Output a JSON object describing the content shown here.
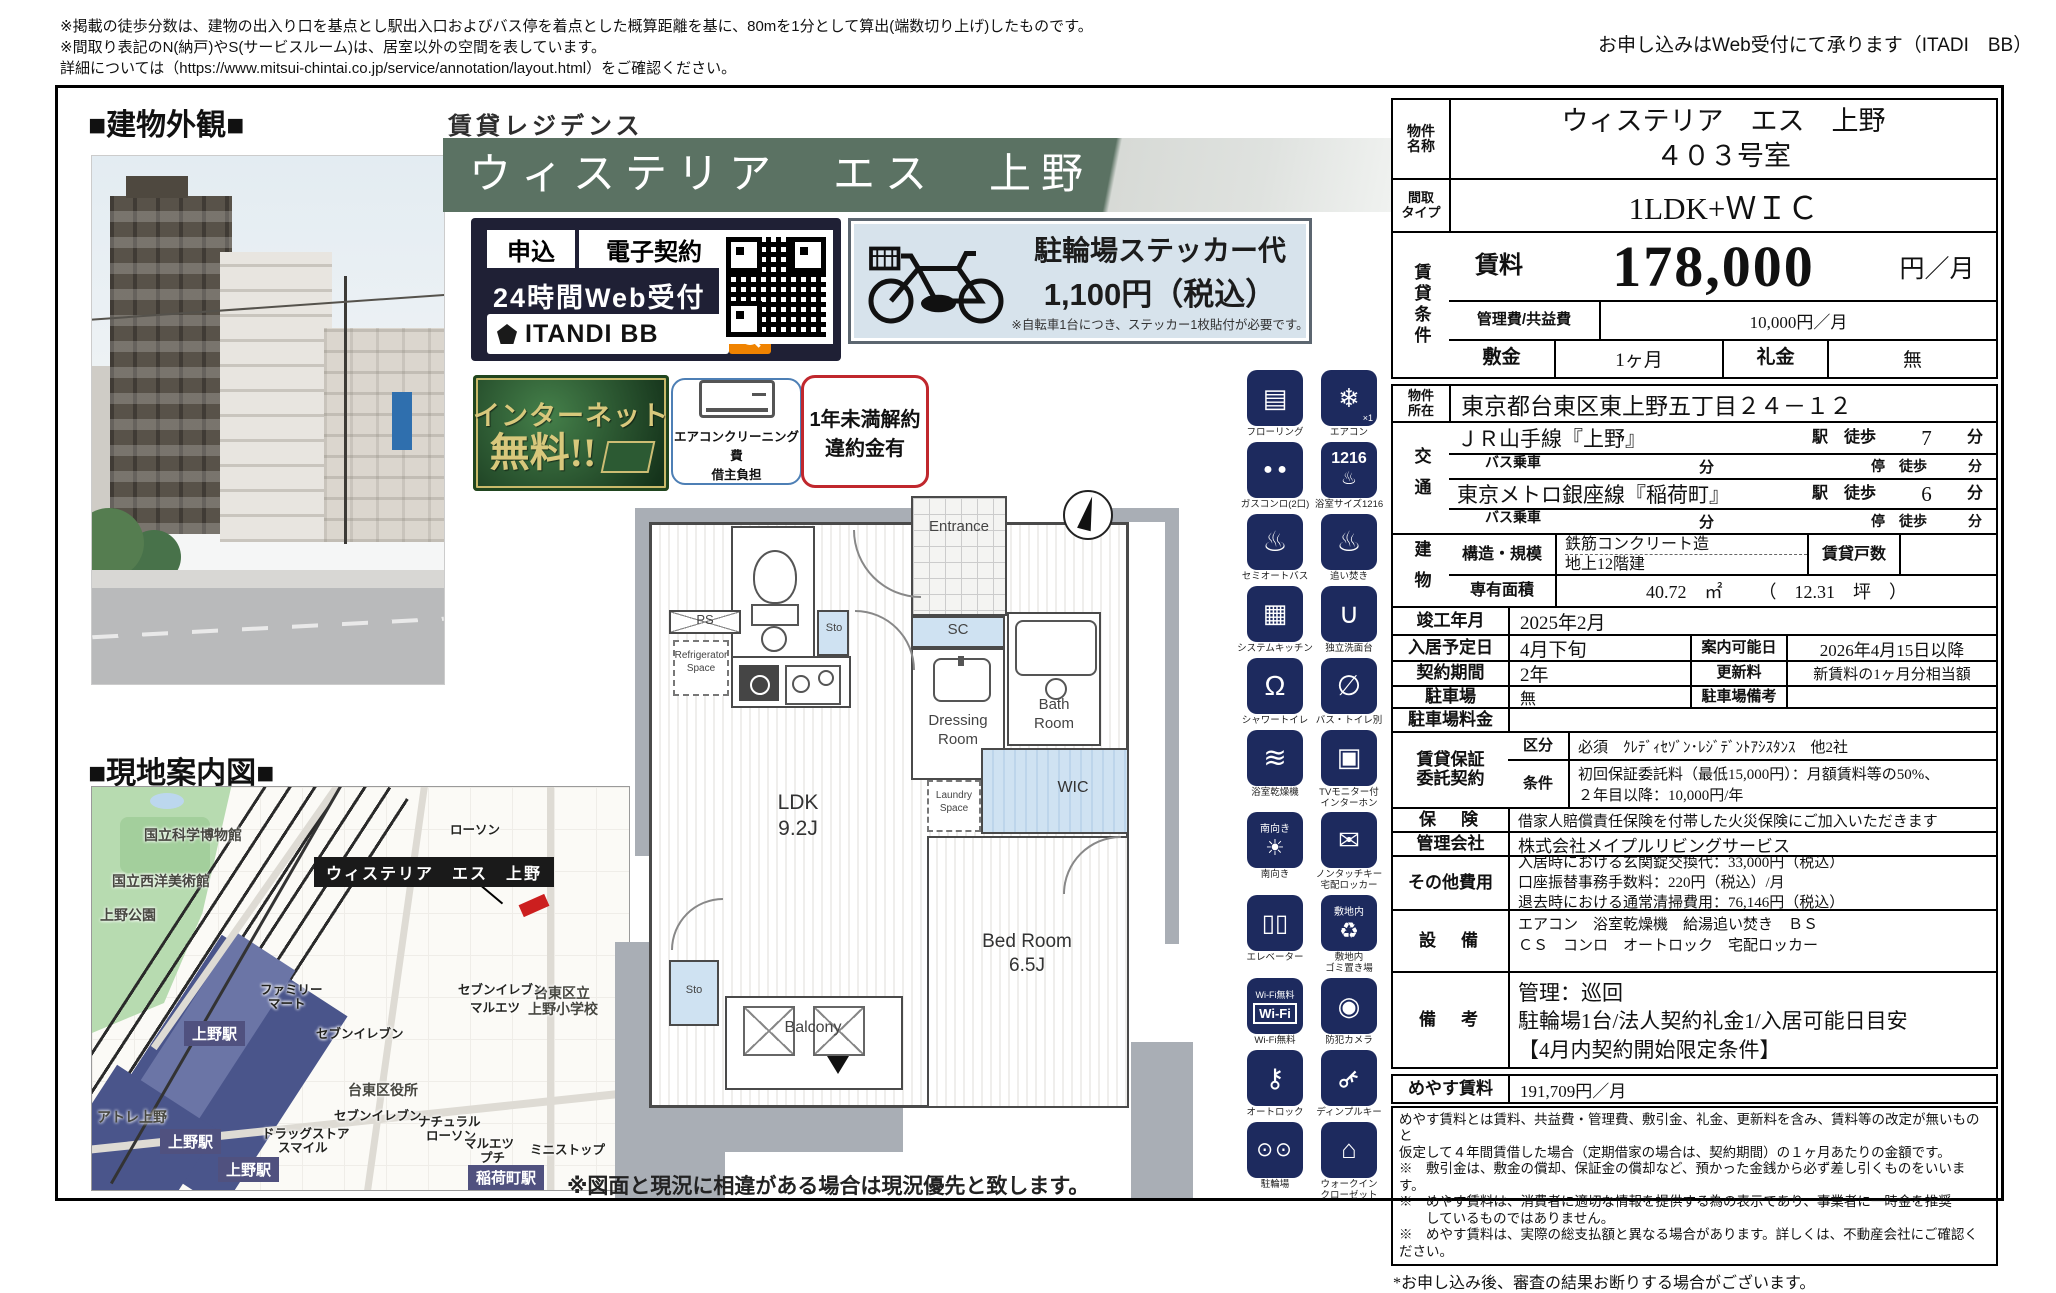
{
  "header": {
    "disclaimer_1": "※掲載の徒歩分数は、建物の出入り口を基点とし駅出入口およびバス停を着点とした概算距離を基に、80mを1分として算出(端数切り上げ)したものです。",
    "disclaimer_2": "※間取り表記のN(納戸)やS(サービスルーム)は、居室以外の空間を表しています。",
    "disclaimer_3": "詳細については（https://www.mitsui-chintai.co.jp/service/annotation/layout.html）をご確認ください。",
    "web_note": "お申し込みはWeb受付にて承ります（ITADI　BB）"
  },
  "left": {
    "exterior_title": "■建物外観■",
    "map_title": "■現地案内図■"
  },
  "banner": {
    "kicker": "賃貸レジデンス",
    "name": "ウィステリア　エス　上野"
  },
  "itandi": {
    "apply": "申込",
    "econtract": "電子契約",
    "web": "24時間Web受付",
    "brand": "ITANDI BB"
  },
  "bike": {
    "line1": "駐輪場ステッカー代",
    "line2": "1,100円（税込）",
    "line3": "※自転車1台につき、ステッカー1枚貼付が必要です。"
  },
  "badges": {
    "internet_1": "インターネット",
    "internet_2": "無料!!",
    "aircon_1": "エアコンクリーニング費",
    "aircon_2": "借主負担",
    "cancel_1": "1年未満解約",
    "cancel_2": "違約金有"
  },
  "fp": {
    "entrance": "Entrance",
    "sc": "SC",
    "sto_upper": "Sto",
    "ps_left": "PS",
    "fridge_1": "Refrigerator",
    "fridge_2": "Space",
    "dressing_1": "Dressing",
    "dressing_2": "Room",
    "bath_1": "Bath",
    "bath_2": "Room",
    "ps_small": "PS",
    "laundry_1": "Laundry",
    "laundry_2": "Space",
    "wic": "WIC",
    "ldk_1": "LDK",
    "ldk_2": "9.2J",
    "bed_1": "Bed Room",
    "bed_2": "6.5J",
    "sto_lower": "Sto",
    "balcony": "Balcony",
    "note": "※図面と現況に相違がある場合は現況優先と致します。"
  },
  "map": {
    "property": "ウィステリア　エス　上野",
    "areas": [
      "国立科学博物館",
      "国立西洋美術館",
      "上野公園",
      "台東区役所",
      "台東区立",
      "上野小学校",
      "アトレ上野"
    ],
    "stations": [
      "上野駅",
      "上野駅",
      "上野駅",
      "稲荷町駅"
    ],
    "pois": [
      "ローソン",
      "ファミリー",
      "マート",
      "セブンイレブン",
      "セブンイレブン",
      "マルエツ",
      "ドラッグストア",
      "スマイル",
      "セブンイレブン",
      "ナチュラル",
      "ローソン",
      "マルエツ",
      "プチ",
      "ミニストップ"
    ]
  },
  "icons": [
    {
      "label": "フローリング",
      "glyph": "▤"
    },
    {
      "label": "エアコン",
      "glyph": "❄",
      "sub": "×1"
    },
    {
      "label": "ガスコンロ(2口)",
      "glyph": "● ●"
    },
    {
      "label": "浴室サイズ1216",
      "glyph": "1216"
    },
    {
      "label": "セミオートバス",
      "glyph": "♨"
    },
    {
      "label": "追い焚き",
      "glyph": "♨"
    },
    {
      "label": "システムキッチン",
      "glyph": "▦"
    },
    {
      "label": "独立洗面台",
      "glyph": "∪"
    },
    {
      "label": "シャワートイレ",
      "glyph": "Ω"
    },
    {
      "label": "バス・トイレ別",
      "glyph": "∅"
    },
    {
      "label": "浴室乾燥機",
      "glyph": "≋"
    },
    {
      "label": "TVモニター付",
      "label2": "インターホン",
      "glyph": "▣"
    },
    {
      "label": "南向き",
      "glyph": "☀",
      "top": "南向き"
    },
    {
      "label": "ノンタッチキー",
      "label2": "宅配ロッカー",
      "glyph": "✉"
    },
    {
      "label": "エレベーター",
      "glyph": "▯▯"
    },
    {
      "label": "敷地内",
      "label2": "ゴミ置き場",
      "glyph": "♻",
      "top": "敷地内"
    },
    {
      "label": "Wi-Fi無料",
      "glyph": "Wi-Fi",
      "top": "Wi-Fi無料"
    },
    {
      "label": "防犯カメラ",
      "glyph": "◉"
    },
    {
      "label": "オートロック",
      "glyph": "⚷"
    },
    {
      "label": "ディンプルキー",
      "glyph": "⚷"
    },
    {
      "label": "駐輪場",
      "glyph": "⊙⊙"
    },
    {
      "label": "ウォークイン",
      "label2": "クローゼット",
      "glyph": "⌂"
    }
  ],
  "table": {
    "name_label_1": "物件",
    "name_label_2": "名称",
    "name_value_1": "ウィステリア　エス　上野",
    "name_value_2": "４０３号室",
    "type_label_1": "間取",
    "type_label_2": "タイプ",
    "type_value": "1LDK+ＷＩＣ",
    "cond_label": "賃貸条件",
    "rent_label": "賃料",
    "rent_value": "178,000",
    "rent_unit": "円／月",
    "mgmt_label": "管理費/共益費",
    "mgmt_value": "10,000円／月",
    "deposit_label": "敷金",
    "deposit_value": "1ヶ月",
    "key_label": "礼金",
    "key_value": "無",
    "addr_label_1": "物件",
    "addr_label_2": "所在",
    "addr_value": "東京都台東区東上野五丁目２４－１２",
    "transport_label": "交通",
    "t1_line": "ＪＲ山手線『上野』",
    "t1_mid": "駅　徒歩",
    "t1_min": "7",
    "t1_unit": "分",
    "t2_line": "バス乗車",
    "t2_blank_unit": "分",
    "t2_mid": "停　徒歩",
    "t2_unit": "分",
    "t3_line": "東京メトロ銀座線『稲荷町』",
    "t3_mid": "駅　徒歩",
    "t3_min": "6",
    "t3_unit": "分",
    "t4_line": "バス乗車",
    "t4_blank_unit": "分",
    "t4_mid": "停　徒歩",
    "t4_unit": "分",
    "bld_label": "建物",
    "structure_label": "構造・規模",
    "structure_value_1": "鉄筋コンクリート造",
    "structure_value_2": "地上12階建",
    "units_label": "賃貸戸数",
    "units_value": "",
    "area_label": "専有面積",
    "area_value": "40.72　㎡",
    "area_tsubo": "（　12.31　坪　）",
    "completion_label": "竣工年月",
    "completion_value": "2025年2月",
    "movein_label": "入居予定日",
    "movein_value": "4月下旬",
    "guide_label": "案内可能日",
    "guide_value": "2026年4月15日以降",
    "contract_label": "契約期間",
    "contract_value": "2年",
    "renewal_label": "更新料",
    "renewal_value": "新賃料の1ヶ月分相当額",
    "parking_label": "駐車場",
    "parking_value": "無",
    "parking_note_label": "駐車場備考",
    "parking_note_value": "",
    "parking_fee_label": "駐車場料金",
    "parking_fee_value": "",
    "guarantee_label_1": "賃貸保証",
    "guarantee_label_2": "委託契約",
    "g_class_label": "区分",
    "g_class_value": "必須　ｸﾚﾃﾞｨｾｿﾞﾝ･ﾚｼﾞﾃﾞﾝﾄｱｼｽﾀﾝｽ　他2社",
    "g_cond_label": "条件",
    "g_cond_value_1": "初回保証委託料（最低15,000円）：月額賃料等の50%、",
    "g_cond_value_2": "２年目以降：10,000円/年",
    "insurance_label": "保　険",
    "insurance_value": "借家人賠償責任保険を付帯した火災保険にご加入いただきます",
    "mgmtco_label": "管理会社",
    "mgmtco_value": "株式会社メイプルリビングサービス",
    "other_label": "その他費用",
    "other_value_1": "入居時における玄関錠交換代：33,000円（税込）",
    "other_value_2": "口座振替事務手数料：220円（税込）/月",
    "other_value_3": "退去時における通常清掃費用：76,146円（税込）",
    "equip_label": "設　備",
    "equip_value_1": "エアコン　浴室乾燥機　給湯追い焚き　ＢＳ",
    "equip_value_2": "ＣＳ　コンロ　オートロック　宅配ロッカー",
    "remarks_label": "備　考",
    "remarks_value_1": "管理：巡回",
    "remarks_value_2": "駐輪場1台/法人契約礼金1/入居可能日目安",
    "remarks_value_3": "【4月内契約開始限定条件】",
    "meyasu_label": "めやす賃料",
    "meyasu_value": "191,709円／月",
    "note_1": "めやす賃料とは賃料、共益費・管理費、敷引金、礼金、更新料を含み、賃料等の改定が無いものと",
    "note_2": "仮定して４年間賃借した場合（定期借家の場合は、契約期間）の１ヶ月あたりの金額です。",
    "note_3": "※　敷引金は、敷金の償却、保証金の償却など、預かった金銭から必ず差し引くものをいいます。",
    "note_4": "※　めやす賃料は、消費者に適切な情報を提供する為の表示であり、事業者に一時金を推奨",
    "note_5": "　　しているものではありません。",
    "note_6": "※　めやす賃料は、実際の総支払額と異なる場合があります。詳しくは、不動産会社にご確認ください。",
    "footer_note": "*お申し込み後、審査の結果お断りする場合がございます。"
  }
}
